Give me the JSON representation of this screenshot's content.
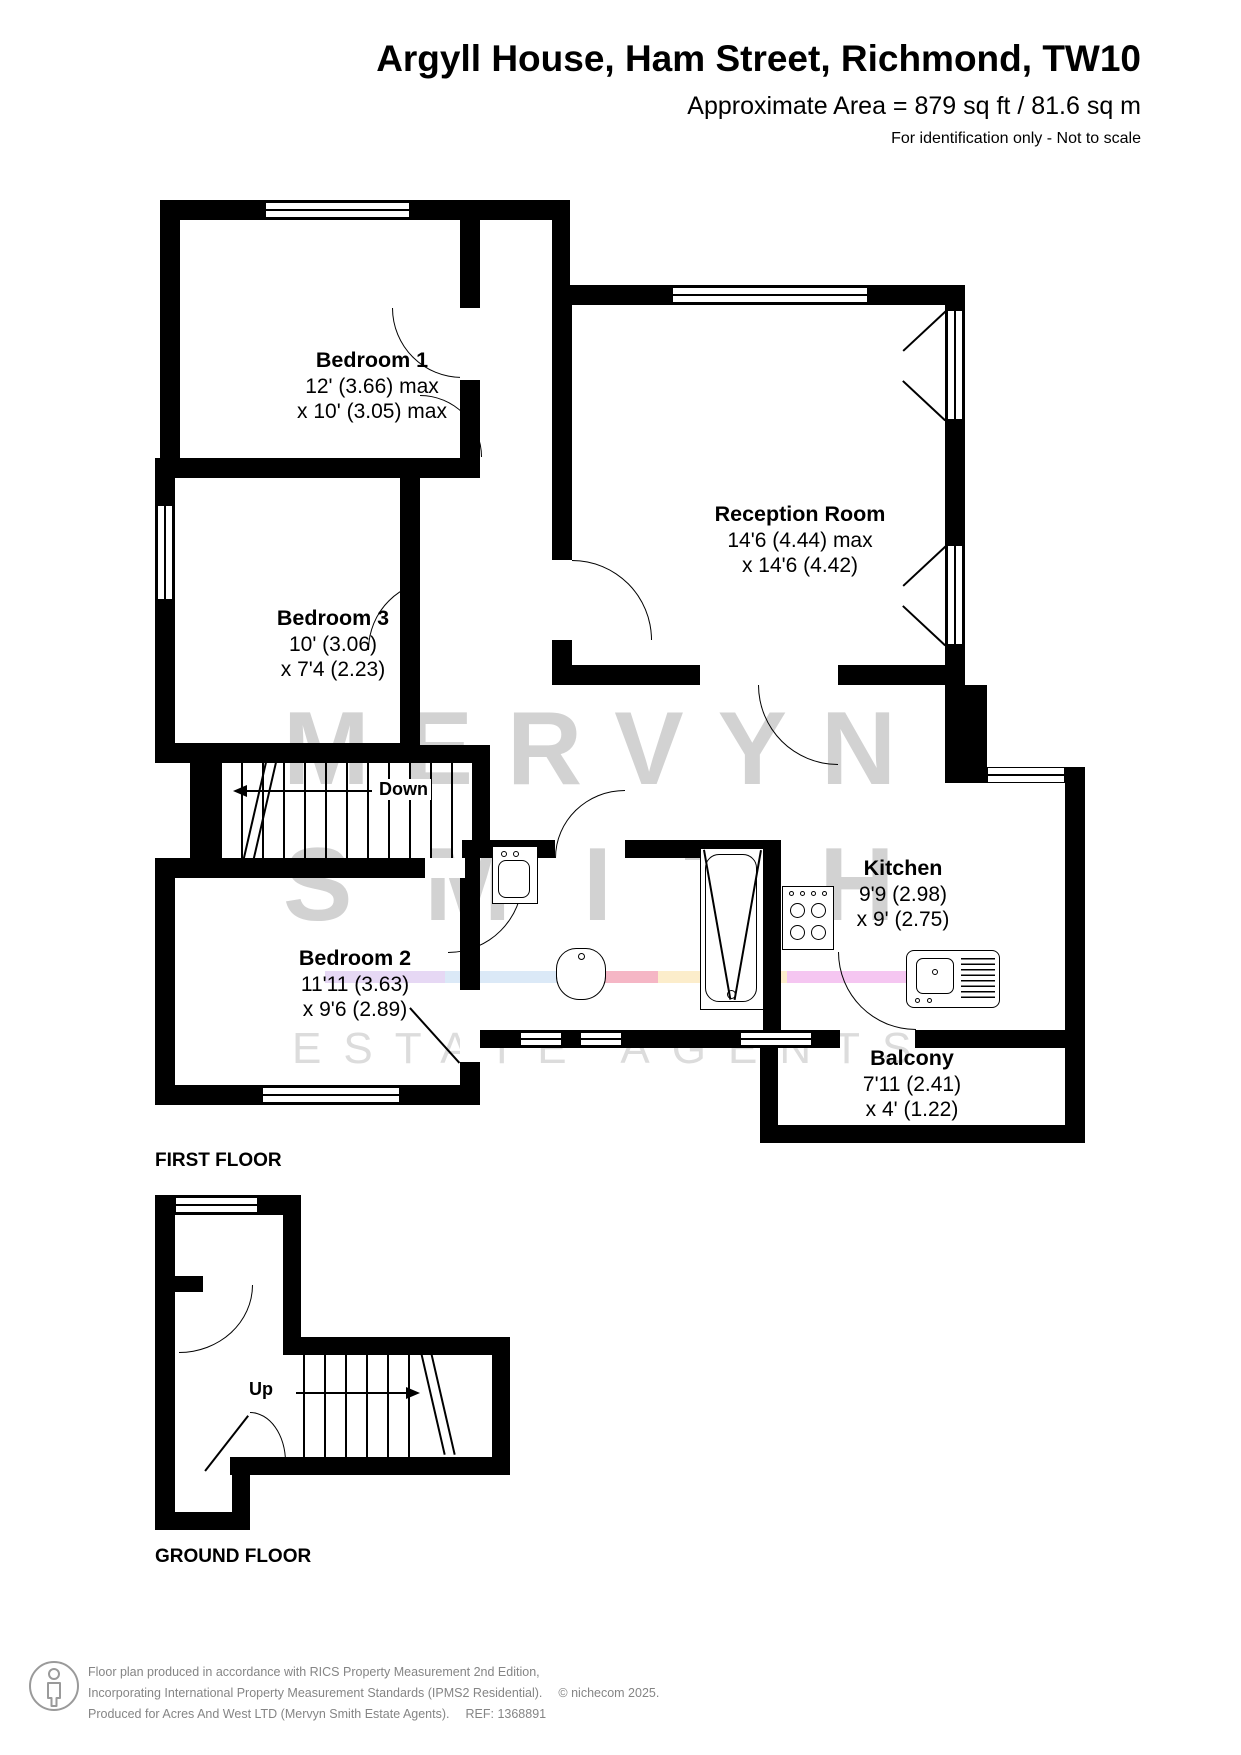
{
  "header": {
    "title": "Argyll House, Ham Street, Richmond, TW10",
    "area_line": "Approximate Area = 879 sq ft / 81.6 sq m",
    "note": "For identification only - Not to scale"
  },
  "first_floor": {
    "floor_label": "FIRST FLOOR",
    "stairs_label": "Down",
    "rooms": {
      "bedroom1": {
        "name": "Bedroom 1",
        "dim1": "12' (3.66) max",
        "dim2": "x 10' (3.05) max"
      },
      "bedroom3": {
        "name": "Bedroom 3",
        "dim1": "10' (3.06)",
        "dim2": "x 7'4 (2.23)"
      },
      "reception": {
        "name": "Reception Room",
        "dim1": "14'6 (4.44) max",
        "dim2": "x 14'6 (4.42)"
      },
      "kitchen": {
        "name": "Kitchen",
        "dim1": "9'9 (2.98)",
        "dim2": "x 9' (2.75)"
      },
      "bedroom2": {
        "name": "Bedroom 2",
        "dim1": "11'11 (3.63)",
        "dim2": "x 9'6 (2.89)"
      },
      "balcony": {
        "name": "Balcony",
        "dim1": "7'11 (2.41)",
        "dim2": "x 4' (1.22)"
      }
    }
  },
  "ground_floor": {
    "floor_label": "GROUND FLOOR",
    "stairs_label": "Up"
  },
  "watermark": {
    "line1": "MERVYN",
    "line2": "SMITH",
    "line3": "ESTATE AGENTS",
    "stripe_colors": [
      "#e6d8f4",
      "#dbe9f7",
      "#eef3fa",
      "#f5b6c5",
      "#fcedcb",
      "#f5c6f1"
    ]
  },
  "footer": {
    "line1": "Floor plan produced in accordance with RICS Property Measurement 2nd Edition,",
    "line2": "Incorporating International Property Measurement Standards (IPMS2 Residential).",
    "line3": "Produced for Acres And West LTD (Mervyn Smith Estate Agents).",
    "ref": "REF: 1368891",
    "copyright": "© nichecom 2025."
  },
  "colors": {
    "wall": "#000000",
    "watermark_text": "#d2d2d2",
    "watermark_light": "#dcdcdc",
    "footer_text": "#858585"
  }
}
